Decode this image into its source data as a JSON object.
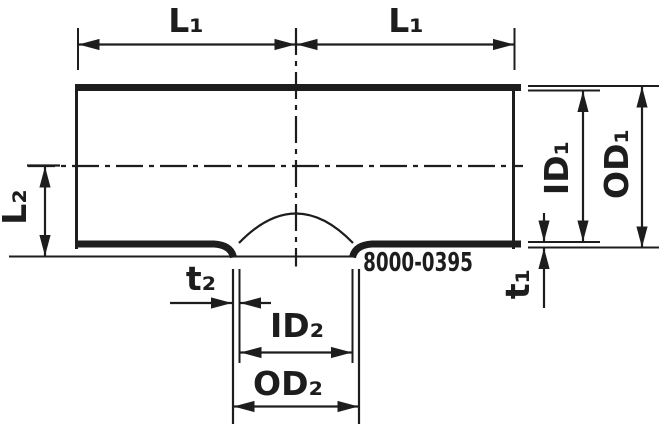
{
  "drawing": {
    "part_number": "8000-0395",
    "labels": {
      "l1_left": "L₁",
      "l1_right": "L₁",
      "l2": "L₂",
      "id1": "ID₁",
      "od1": "OD₁",
      "t1": "t₁",
      "t2": "t₂",
      "id2": "ID₂",
      "od2": "OD₂"
    },
    "colors": {
      "line": "#1d1d1d",
      "background": "#ffffff"
    }
  }
}
